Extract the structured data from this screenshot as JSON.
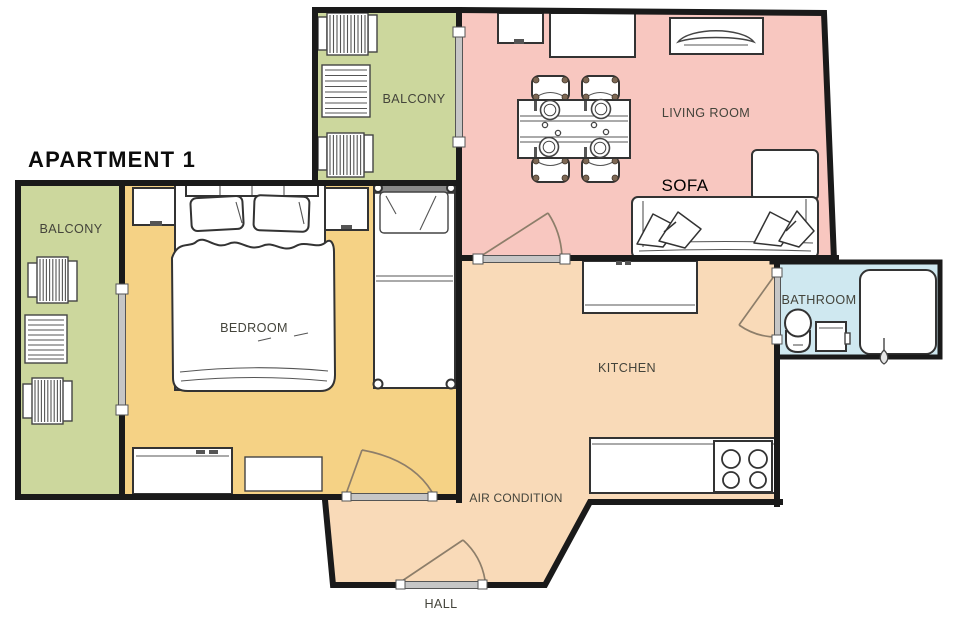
{
  "title": "APARTMENT 1",
  "rooms": {
    "balcony_left": {
      "label": "BALCONY",
      "color": "#ccd79d"
    },
    "balcony_top": {
      "label": "BALCONY",
      "color": "#ccd79d"
    },
    "bedroom": {
      "label": "BEDROOM",
      "color": "#f5d285"
    },
    "living_room": {
      "label": "LIVING ROOM",
      "color": "#f8c7c0"
    },
    "kitchen": {
      "label": "KITCHEN",
      "color": "#f9dab8"
    },
    "hall": {
      "label": "HALL",
      "color": "#f9dab8"
    },
    "bathroom": {
      "label": "BATHROOM",
      "color": "#cfe8f0"
    }
  },
  "annotations": {
    "sofa": "SOFA",
    "air_condition": "AIR CONDITION"
  },
  "colors": {
    "background": "#ffffff",
    "wall": "#1a1a1a",
    "door_bar": "#c6c6c6",
    "door_swing": "#8d7e6a",
    "label_text": "#44443b",
    "annotation_text": "#000000"
  }
}
